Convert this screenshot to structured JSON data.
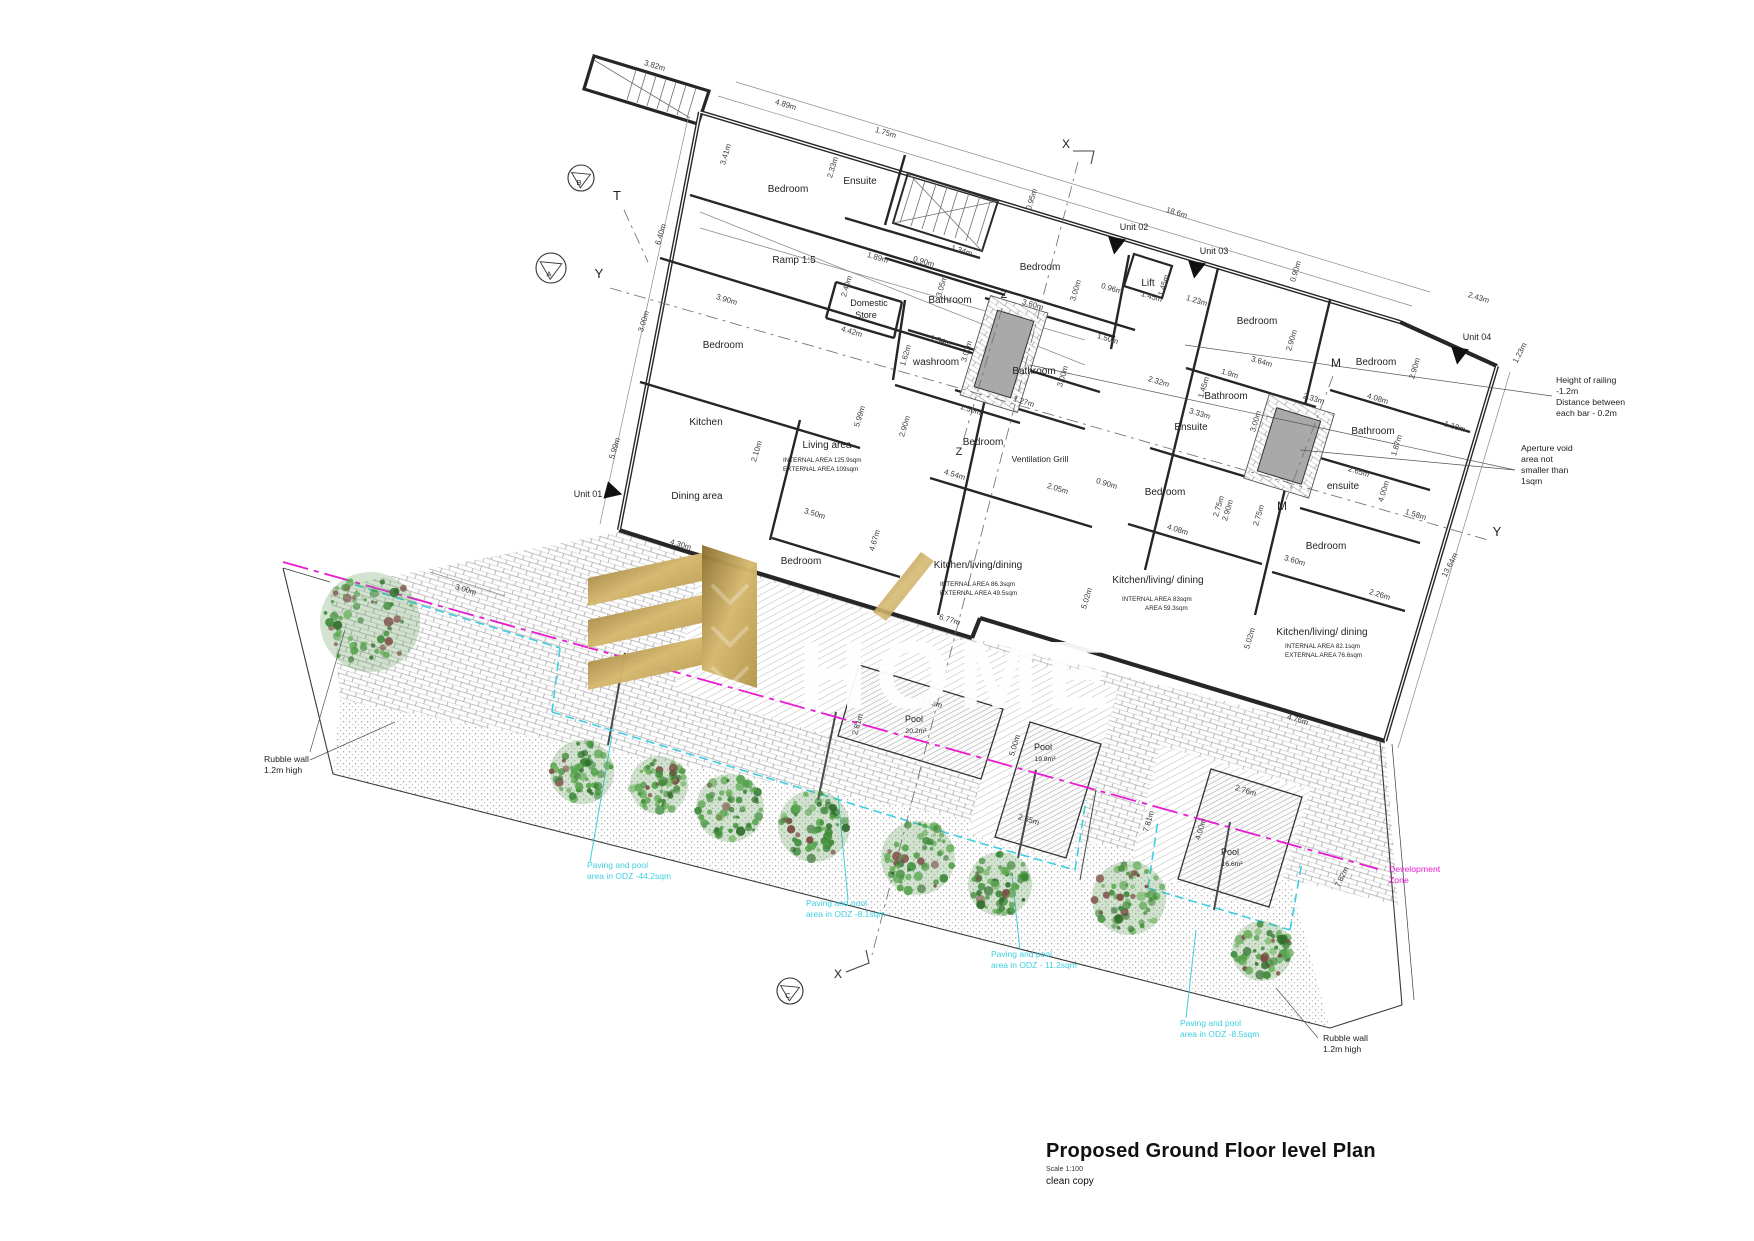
{
  "title_block": {
    "title": "Proposed Ground Floor level Plan",
    "scale": "Scale 1:100",
    "copy": "clean copy"
  },
  "watermark": {
    "text": "HOME"
  },
  "colors": {
    "cyan": "#3ecfe0",
    "magenta": "#e81bd1",
    "wall": "#262626",
    "dim_text": "#3a3a3a",
    "room_text": "#1f1f1f",
    "shaft_grey": "#a9a9a9",
    "gold_dark": "#8d7030",
    "gold_mid": "#c2a254",
    "gold_light": "#d6b96f"
  },
  "plan": {
    "rooms": [
      {
        "t": "Bedroom",
        "x": 788,
        "y": 192
      },
      {
        "t": "Ensuite",
        "x": 860,
        "y": 184
      },
      {
        "t": "Ramp 1:5",
        "x": 794,
        "y": 263
      },
      {
        "t": "Domestic",
        "x": 869,
        "y": 306,
        "s": 9
      },
      {
        "t": "Store",
        "x": 866,
        "y": 318,
        "s": 9
      },
      {
        "t": "Bathroom",
        "x": 950,
        "y": 303
      },
      {
        "t": "washroom",
        "x": 936,
        "y": 365
      },
      {
        "t": "Bedroom",
        "x": 723,
        "y": 348
      },
      {
        "t": "Kitchen",
        "x": 706,
        "y": 425
      },
      {
        "t": "Dining area",
        "x": 697,
        "y": 499
      },
      {
        "t": "Living area",
        "x": 827,
        "y": 448
      },
      {
        "t": "Bedroom",
        "x": 1040,
        "y": 270
      },
      {
        "t": "Lift",
        "x": 1148,
        "y": 286
      },
      {
        "t": "Bathroom",
        "x": 1034,
        "y": 374
      },
      {
        "t": "Bedroom",
        "x": 983,
        "y": 445
      },
      {
        "t": "Ventilation Grill",
        "x": 1040,
        "y": 462,
        "s": 8.5
      },
      {
        "t": "Bedroom",
        "x": 1257,
        "y": 324
      },
      {
        "t": "Bathroom",
        "x": 1226,
        "y": 399
      },
      {
        "t": "Ensuite",
        "x": 1191,
        "y": 430
      },
      {
        "t": "Bedroom",
        "x": 1165,
        "y": 495
      },
      {
        "t": "Bedroom",
        "x": 1376,
        "y": 365
      },
      {
        "t": "Bathroom",
        "x": 1373,
        "y": 434
      },
      {
        "t": "ensuite",
        "x": 1343,
        "y": 489
      },
      {
        "t": "Bedroom",
        "x": 1326,
        "y": 549
      },
      {
        "t": "Bedroom",
        "x": 801,
        "y": 564
      },
      {
        "t": "Kitchen/living/dining",
        "x": 978,
        "y": 568
      },
      {
        "t": "Kitchen/living/ dining",
        "x": 1158,
        "y": 583
      },
      {
        "t": "Kitchen/living/ dining",
        "x": 1322,
        "y": 635
      }
    ],
    "area_labels": [
      {
        "t": "INTERNAL AREA   125.9sqm",
        "x": 783,
        "y": 462
      },
      {
        "t": "EXTERNAL AREA   109sqm",
        "x": 783,
        "y": 471
      },
      {
        "t": "INTERNAL AREA   86.3sqm",
        "x": 940,
        "y": 586
      },
      {
        "t": "EXTERNAL AREA   49.5sqm",
        "x": 940,
        "y": 595
      },
      {
        "t": "INTERNAL AREA   83sqm",
        "x": 1122,
        "y": 601
      },
      {
        "t": "AREA   59.3sqm",
        "x": 1145,
        "y": 610
      },
      {
        "t": "INTERNAL AREA   82.1sqm",
        "x": 1285,
        "y": 648
      },
      {
        "t": "EXTERNAL AREA   76.6sqm",
        "x": 1285,
        "y": 657
      }
    ],
    "dims": [
      {
        "t": "3.82m",
        "x": 654,
        "y": 68,
        "r": 17
      },
      {
        "t": "4.89m",
        "x": 785,
        "y": 107,
        "r": 17
      },
      {
        "t": "1.75m",
        "x": 885,
        "y": 135,
        "r": 17
      },
      {
        "t": "3.41m",
        "x": 728,
        "y": 155,
        "r": -73
      },
      {
        "t": "2.33m",
        "x": 835,
        "y": 168,
        "r": -73
      },
      {
        "t": "6.40m",
        "x": 663,
        "y": 235,
        "r": -73
      },
      {
        "t": "3.90m",
        "x": 726,
        "y": 302,
        "r": 17
      },
      {
        "t": "3.00m",
        "x": 646,
        "y": 322,
        "r": -73
      },
      {
        "t": "1.89m",
        "x": 877,
        "y": 260,
        "r": 17
      },
      {
        "t": "0.90m",
        "x": 923,
        "y": 264,
        "r": 17
      },
      {
        "t": "1.34m",
        "x": 961,
        "y": 253,
        "r": 17
      },
      {
        "t": "3.05m",
        "x": 944,
        "y": 287,
        "r": -73
      },
      {
        "t": "2.40m",
        "x": 849,
        "y": 287,
        "r": -73
      },
      {
        "t": "4.42m",
        "x": 851,
        "y": 334,
        "r": 17
      },
      {
        "t": "1.62m",
        "x": 908,
        "y": 356,
        "r": -73
      },
      {
        "t": "1.34m",
        "x": 940,
        "y": 343,
        "r": 17
      },
      {
        "t": "3.00m",
        "x": 969,
        "y": 352,
        "r": -73
      },
      {
        "t": "0.95m",
        "x": 1034,
        "y": 200,
        "r": -73
      },
      {
        "t": "18.6m",
        "x": 1176,
        "y": 215,
        "r": 17
      },
      {
        "t": "0.96m",
        "x": 1111,
        "y": 291,
        "r": 17
      },
      {
        "t": "1.45m",
        "x": 1151,
        "y": 299,
        "r": 17
      },
      {
        "t": "1.45m",
        "x": 1166,
        "y": 286,
        "r": -73
      },
      {
        "t": "1.23m",
        "x": 1196,
        "y": 303,
        "r": 17
      },
      {
        "t": "3.00m",
        "x": 1078,
        "y": 291,
        "r": -73
      },
      {
        "t": "3.60m",
        "x": 1032,
        "y": 307,
        "r": 17
      },
      {
        "t": "0.90m",
        "x": 1298,
        "y": 272,
        "r": -73
      },
      {
        "t": "2.90m",
        "x": 1294,
        "y": 341,
        "r": -73
      },
      {
        "t": "3.64m",
        "x": 1261,
        "y": 364,
        "r": 17
      },
      {
        "t": "1.9m",
        "x": 1229,
        "y": 376,
        "r": 17
      },
      {
        "t": "1.45m",
        "x": 1206,
        "y": 388,
        "r": -73
      },
      {
        "t": "2.32m",
        "x": 1158,
        "y": 384,
        "r": 17
      },
      {
        "t": "2.33m",
        "x": 1313,
        "y": 401,
        "r": 17
      },
      {
        "t": "3.33m",
        "x": 1199,
        "y": 416,
        "r": 17
      },
      {
        "t": "3.00m",
        "x": 1258,
        "y": 422,
        "r": -73
      },
      {
        "t": "2.43m",
        "x": 1478,
        "y": 300,
        "r": 17
      },
      {
        "t": "1.23m",
        "x": 1522,
        "y": 354,
        "r": -63
      },
      {
        "t": "2.90m",
        "x": 1417,
        "y": 369,
        "r": -73
      },
      {
        "t": "4.08m",
        "x": 1377,
        "y": 401,
        "r": 17
      },
      {
        "t": "1.18m",
        "x": 1454,
        "y": 429,
        "r": 17
      },
      {
        "t": "1.87m",
        "x": 1399,
        "y": 446,
        "r": -73
      },
      {
        "t": "2.65m",
        "x": 1358,
        "y": 474,
        "r": 17
      },
      {
        "t": "4.00m",
        "x": 1386,
        "y": 492,
        "r": -73
      },
      {
        "t": "1.58m",
        "x": 1415,
        "y": 517,
        "r": 17
      },
      {
        "t": "0.90m",
        "x": 1106,
        "y": 486,
        "r": 17
      },
      {
        "t": "2.75m",
        "x": 1221,
        "y": 507,
        "r": -73
      },
      {
        "t": "2.75m",
        "x": 1261,
        "y": 516,
        "r": -73
      },
      {
        "t": "4.08m",
        "x": 1177,
        "y": 532,
        "r": 17
      },
      {
        "t": "3.60m",
        "x": 1294,
        "y": 563,
        "r": 17
      },
      {
        "t": "2.26m",
        "x": 1379,
        "y": 597,
        "r": 17
      },
      {
        "t": "13.64m",
        "x": 1452,
        "y": 566,
        "r": -63
      },
      {
        "t": "4.76m",
        "x": 1297,
        "y": 722,
        "r": 17
      },
      {
        "t": "5.02m",
        "x": 1252,
        "y": 639,
        "r": -73
      },
      {
        "t": "5.02m",
        "x": 1089,
        "y": 599,
        "r": -73
      },
      {
        "t": "4.54m",
        "x": 954,
        "y": 477,
        "r": 17
      },
      {
        "t": "2.05m",
        "x": 1057,
        "y": 491,
        "r": 17
      },
      {
        "t": "4.67m",
        "x": 877,
        "y": 541,
        "r": -73
      },
      {
        "t": "6.77m",
        "x": 949,
        "y": 622,
        "r": 17
      },
      {
        "t": "2.10m",
        "x": 759,
        "y": 452,
        "r": -73
      },
      {
        "t": "3.50m",
        "x": 814,
        "y": 516,
        "r": 17
      },
      {
        "t": "4.30m",
        "x": 680,
        "y": 547,
        "r": 17
      },
      {
        "t": "2.90m",
        "x": 907,
        "y": 427,
        "r": -73
      },
      {
        "t": "5.99m",
        "x": 862,
        "y": 417,
        "r": -73
      },
      {
        "t": "5.99m",
        "x": 617,
        "y": 449,
        "r": -73
      },
      {
        "t": "1.50m",
        "x": 970,
        "y": 412,
        "r": 17
      },
      {
        "t": "1.27m",
        "x": 1023,
        "y": 404,
        "r": 17
      },
      {
        "t": "3.00m",
        "x": 1065,
        "y": 377,
        "r": -73
      },
      {
        "t": "2.90m",
        "x": 1230,
        "y": 511,
        "r": -73
      },
      {
        "t": "1.50m",
        "x": 1107,
        "y": 341,
        "r": 17
      },
      {
        "t": "3.00m",
        "x": 465,
        "y": 592,
        "r": 17
      },
      {
        "t": "4.65m",
        "x": 931,
        "y": 705,
        "r": 17
      },
      {
        "t": "2.81m",
        "x": 860,
        "y": 725,
        "r": -73
      },
      {
        "t": "5.00m",
        "x": 1017,
        "y": 746,
        "r": -73
      },
      {
        "t": "2.65m",
        "x": 1028,
        "y": 822,
        "r": 17
      },
      {
        "t": "2.76m",
        "x": 1245,
        "y": 793,
        "r": 17
      },
      {
        "t": "4.00m",
        "x": 1203,
        "y": 830,
        "r": -73
      },
      {
        "t": "7.81m",
        "x": 1151,
        "y": 822,
        "r": -73
      },
      {
        "t": "7.82m",
        "x": 1344,
        "y": 878,
        "r": -63
      }
    ],
    "markers": [
      {
        "t": "X",
        "x": 1066,
        "y": 148,
        "s": 12
      },
      {
        "t": "X",
        "x": 838,
        "y": 978,
        "s": 12
      },
      {
        "t": "Y",
        "x": 599,
        "y": 278,
        "s": 13
      },
      {
        "t": "Y",
        "x": 1497,
        "y": 536,
        "s": 13
      },
      {
        "t": "T",
        "x": 617,
        "y": 200,
        "s": 13
      },
      {
        "t": "Z",
        "x": 1004,
        "y": 298,
        "s": 11
      },
      {
        "t": "Z",
        "x": 959,
        "y": 455,
        "s": 11
      },
      {
        "t": "M",
        "x": 1336,
        "y": 367,
        "s": 12
      },
      {
        "t": "M",
        "x": 1282,
        "y": 510,
        "s": 12
      }
    ],
    "units": [
      {
        "label": "Unit 01",
        "x": 588,
        "y": 497,
        "ax": 606,
        "ay": 489,
        "rot": 15
      },
      {
        "label": "Unit 02",
        "x": 1134,
        "y": 230,
        "ax": 1118,
        "ay": 238,
        "rot": 100
      },
      {
        "label": "Unit 03",
        "x": 1214,
        "y": 254,
        "ax": 1198,
        "ay": 262,
        "rot": 100
      },
      {
        "label": "Unit 04",
        "x": 1477,
        "y": 340,
        "ax": 1461,
        "ay": 348,
        "rot": 100
      }
    ],
    "view_points": [
      {
        "letter": "B",
        "x": 581,
        "y": 178,
        "r": 13
      },
      {
        "letter": "A",
        "x": 551,
        "y": 268,
        "r": 15
      },
      {
        "letter": "C",
        "x": 790,
        "y": 991,
        "r": 13
      }
    ],
    "pools": [
      {
        "label": "Pool",
        "area": "20.2m²",
        "x": 914,
        "y": 722
      },
      {
        "label": "Pool",
        "area": "19.8m²",
        "x": 1043,
        "y": 750
      },
      {
        "label": "Pool",
        "area": "16.6m²",
        "x": 1230,
        "y": 855
      }
    ]
  },
  "annotations": {
    "notes": [
      {
        "id": "railing-note",
        "x": 1556,
        "y": 383,
        "color": "#222222",
        "lines": [
          "Height of railing",
          "-1.2m",
          "Distance between",
          "each bar - 0.2m"
        ]
      },
      {
        "id": "aperture-note",
        "x": 1521,
        "y": 451,
        "color": "#222222",
        "lines": [
          "Aperture void",
          "area not",
          "smaller than",
          "1sqm"
        ]
      },
      {
        "id": "rubble-wall-left",
        "x": 264,
        "y": 762,
        "color": "#222222",
        "lines": [
          "Rubble wall",
          "1.2m high"
        ]
      },
      {
        "id": "rubble-wall-right",
        "x": 1323,
        "y": 1041,
        "color": "#222222",
        "lines": [
          "Rubble wall",
          "1.2m high"
        ]
      },
      {
        "id": "development-zone",
        "x": 1389,
        "y": 872,
        "color": "#e81bd1",
        "lines": [
          "Development",
          "Zone"
        ]
      }
    ],
    "odz_labels": [
      {
        "x": 587,
        "y": 868,
        "lines": [
          "Paving and pool",
          "area in ODZ -44.2sqm"
        ]
      },
      {
        "x": 806,
        "y": 906,
        "lines": [
          "Paving and pool",
          "area in ODZ -8.1sqm"
        ]
      },
      {
        "x": 991,
        "y": 957,
        "lines": [
          "Paving and pool",
          "area in ODZ - 11.2sqm"
        ]
      },
      {
        "x": 1180,
        "y": 1026,
        "lines": [
          "Paving and pool",
          "area in ODZ -8.5sqm"
        ]
      }
    ]
  },
  "garden": {
    "trees": [
      {
        "x": 370,
        "y": 622,
        "r": 50
      },
      {
        "x": 582,
        "y": 772,
        "r": 32
      },
      {
        "x": 659,
        "y": 785,
        "r": 29
      },
      {
        "x": 730,
        "y": 808,
        "r": 34
      },
      {
        "x": 814,
        "y": 826,
        "r": 36
      },
      {
        "x": 918,
        "y": 858,
        "r": 37
      },
      {
        "x": 1000,
        "y": 884,
        "r": 32
      },
      {
        "x": 1129,
        "y": 898,
        "r": 37
      },
      {
        "x": 1262,
        "y": 951,
        "r": 30
      }
    ]
  }
}
